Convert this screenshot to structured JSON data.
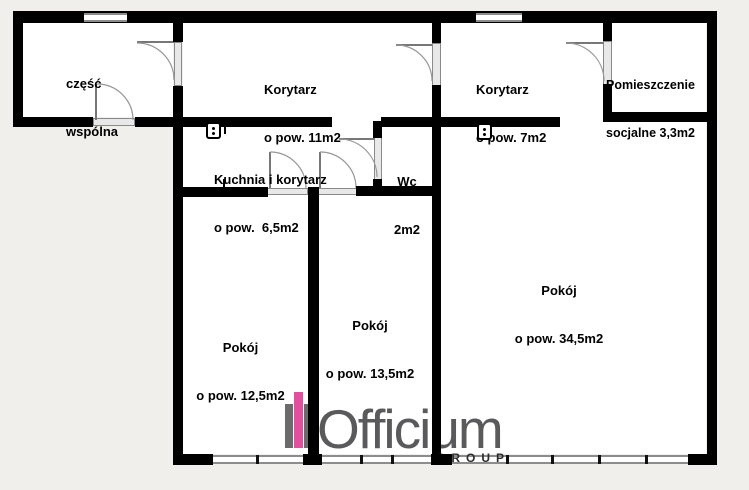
{
  "colors": {
    "background": "#f0efeb",
    "floor": "#ffffff",
    "wall": "#000000",
    "door_sill": "#e8e8e8",
    "accent_pink": "#e0509c",
    "logo_text": "#5a5a5c",
    "logo_group": "#2d2d2f"
  },
  "rooms": [
    {
      "name": "czesc-wspolna",
      "line1": "część",
      "line2": "wspólna"
    },
    {
      "name": "korytarz-11",
      "line1": "Korytarz",
      "line2": "o pow. 11m2"
    },
    {
      "name": "korytarz-7",
      "line1": "Korytarz",
      "line2": "o pow. 7m2"
    },
    {
      "name": "pomieszczenie-socjalne",
      "line1": "Pomieszczenie",
      "line2": "socjalne 3,3m2"
    },
    {
      "name": "kuchnia-i-korytarz",
      "line1": "Kuchnia i korytarz",
      "line2": "o pow.  6,5m2"
    },
    {
      "name": "wc",
      "line1": "Wc",
      "line2": "2m2"
    },
    {
      "name": "pokoj-34",
      "line1": "Pokój",
      "line2": "o pow. 34,5m2"
    },
    {
      "name": "pokoj-13",
      "line1": "Pokój",
      "line2": "o pow. 13,5m2"
    },
    {
      "name": "pokoj-12",
      "line1": "Pokój",
      "line2": "o pow. 12,5m2"
    }
  ],
  "logo": {
    "brand": "Officium",
    "subtitle": "GROUP"
  }
}
